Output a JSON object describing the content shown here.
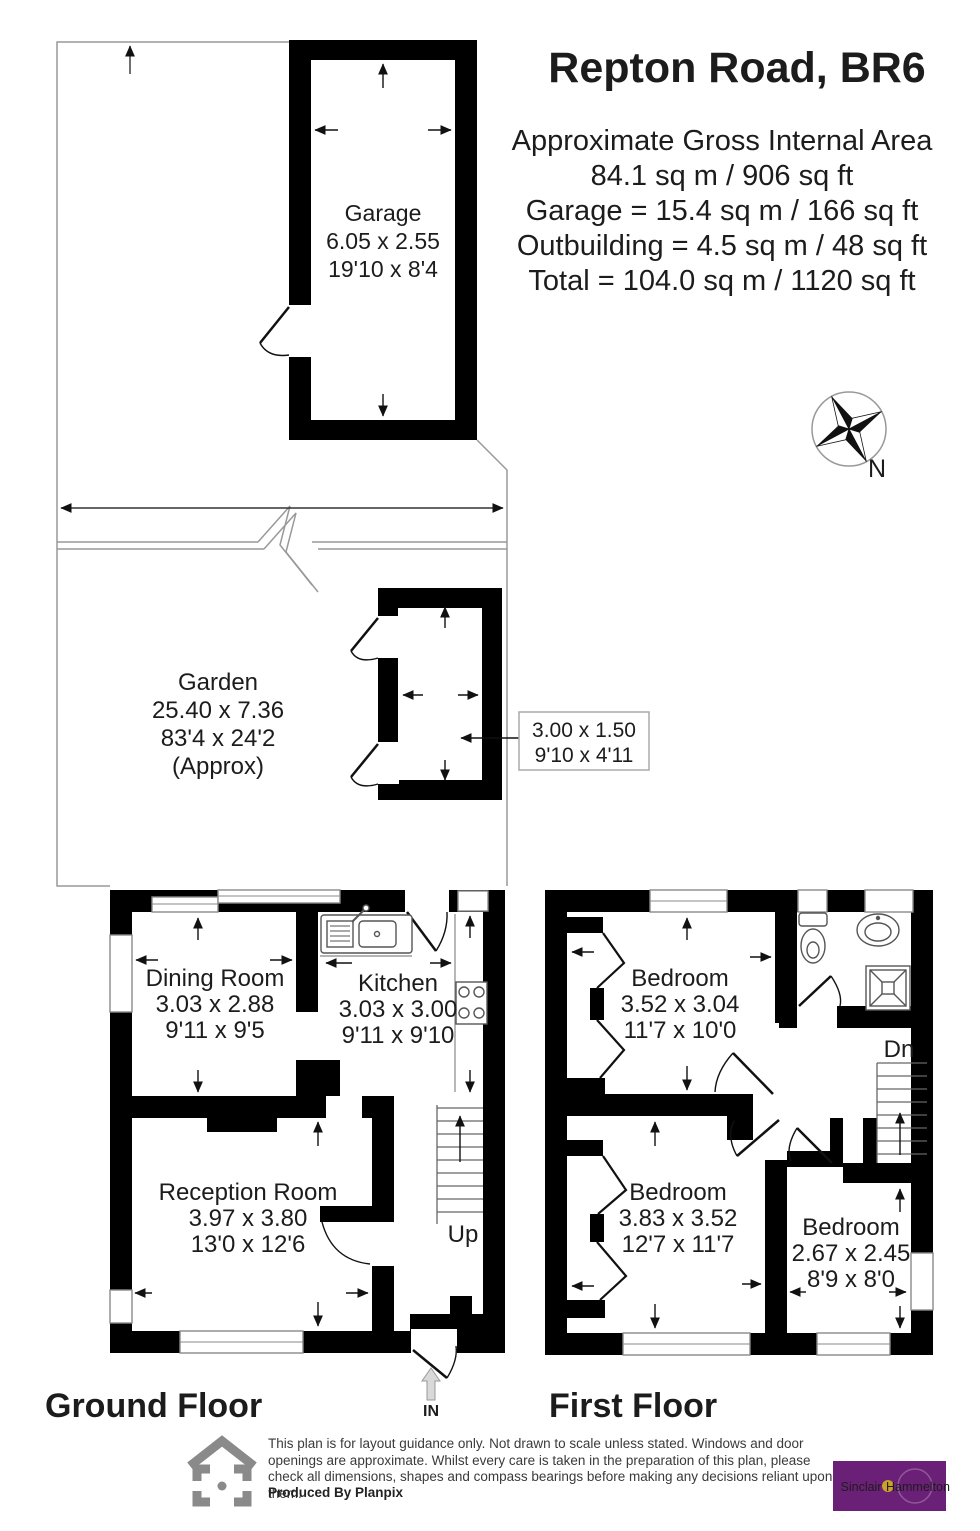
{
  "header": {
    "title": "Repton Road, BR6",
    "area_lines": [
      "Approximate Gross Internal Area",
      "84.1 sq m / 906 sq ft",
      "Garage = 15.4 sq m / 166 sq ft",
      "Outbuilding = 4.5 sq m / 48 sq ft",
      "Total = 104.0 sq m / 1120 sq ft"
    ]
  },
  "compass": {
    "north": "N"
  },
  "rooms": {
    "garage": {
      "name": "Garage",
      "metric": "6.05 x 2.55",
      "imperial": "19'10 x 8'4"
    },
    "garden": {
      "name": "Garden",
      "metric": "25.40 x 7.36",
      "imperial": "83'4 x 24'2",
      "approx": "(Approx)"
    },
    "outbuilding": {
      "metric": "3.00 x 1.50",
      "imperial": "9'10 x 4'11"
    },
    "dining_room": {
      "name": "Dining Room",
      "metric": "3.03 x 2.88",
      "imperial": "9'11 x 9'5"
    },
    "kitchen": {
      "name": "Kitchen",
      "metric": "3.03 x 3.00",
      "imperial": "9'11 x 9'10"
    },
    "reception_room": {
      "name": "Reception Room",
      "metric": "3.97 x 3.80",
      "imperial": "13'0 x 12'6"
    },
    "bedroom1": {
      "name": "Bedroom",
      "metric": "3.52 x 3.04",
      "imperial": "11'7 x 10'0"
    },
    "bedroom2": {
      "name": "Bedroom",
      "metric": "3.83 x 3.52",
      "imperial": "12'7 x 11'7"
    },
    "bedroom3": {
      "name": "Bedroom",
      "metric": "2.67 x 2.45",
      "imperial": "8'9 x 8'0"
    }
  },
  "labels": {
    "up": "Up",
    "down": "Dn",
    "entrance": "IN",
    "ground_floor": "Ground Floor",
    "first_floor": "First Floor"
  },
  "footer": {
    "disclaimer": "This plan is for layout guidance only. Not drawn to scale unless stated. Windows and door openings are approximate. Whilst every care is taken in the preparation of this plan, please check all dimensions, shapes and compass bearings before making any decisions reliant upon them.",
    "produced_by": "Produced By Planpix",
    "brand": {
      "name_left": "Sinclair",
      "name_right": "Hammelton",
      "purple": "#6b2077",
      "gold": "#c9a227"
    }
  }
}
